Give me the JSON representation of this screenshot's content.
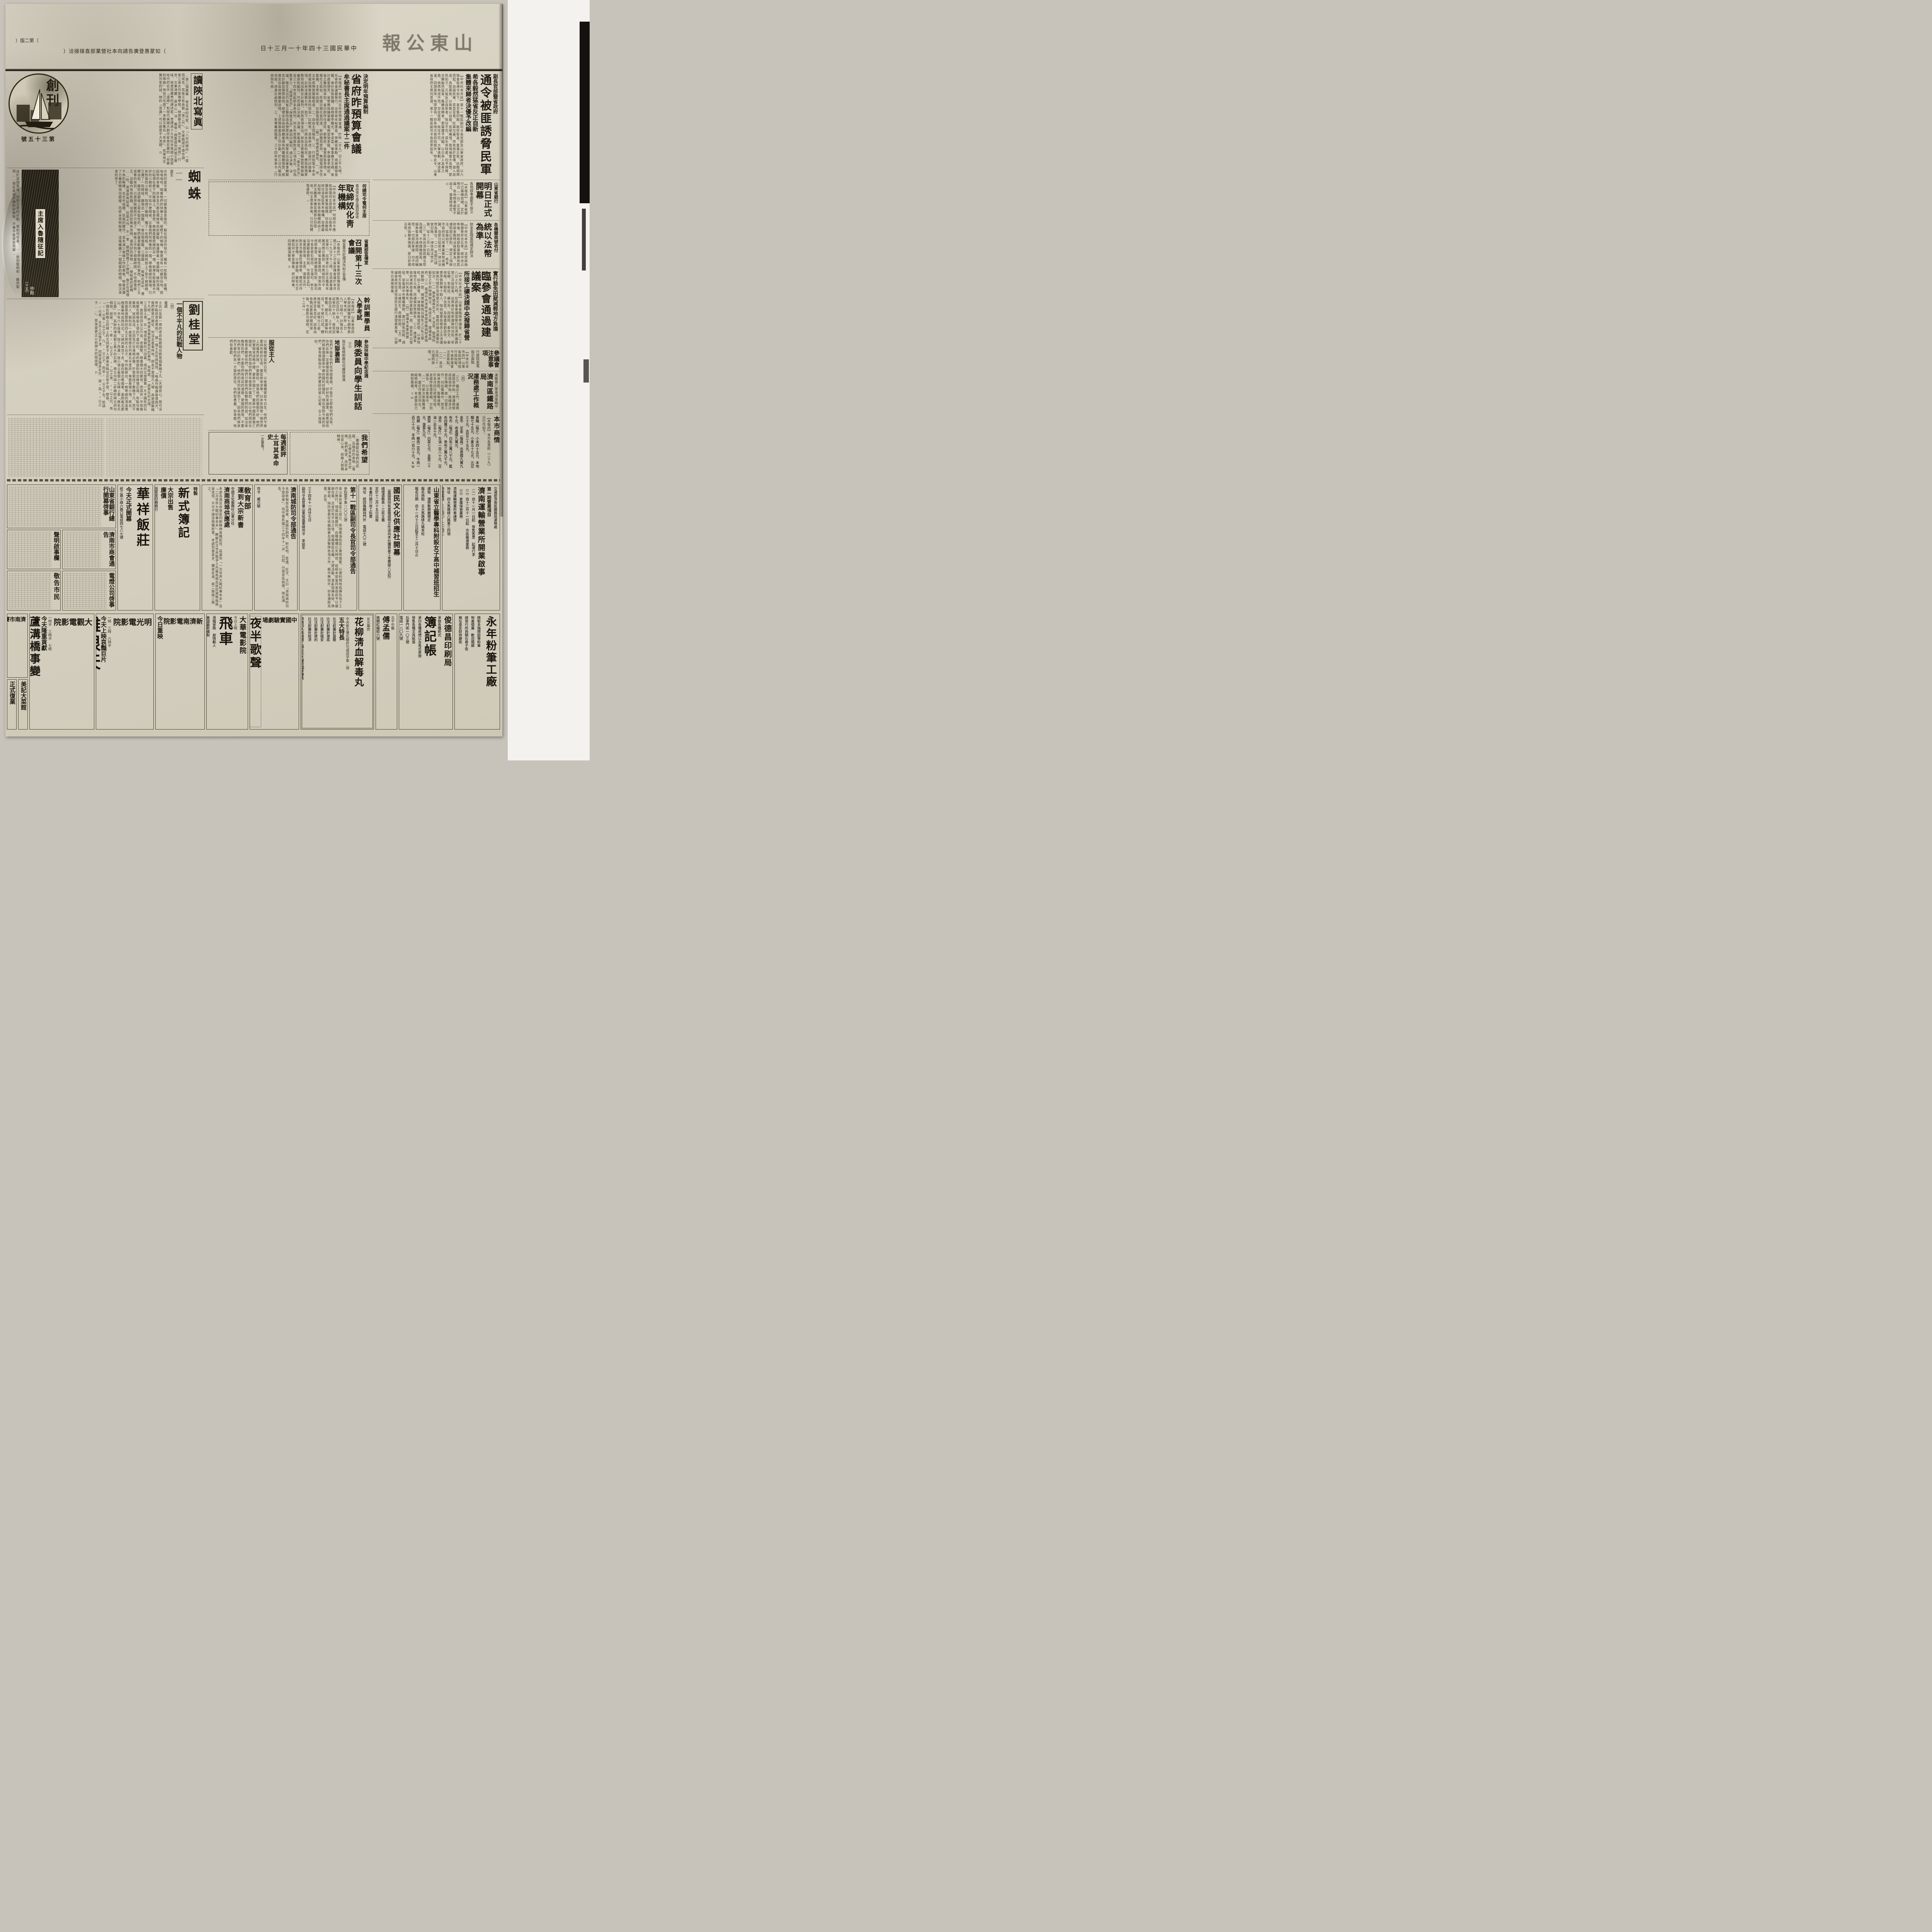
{
  "page": {
    "edition": "（第二版）",
    "title": "山東公報",
    "date": "中華民國三十四年十一月三十日",
    "ad_note": "（如蒙惠登廣告請向本社營業部直接接洽）"
  },
  "articles": {
    "tongling": {
      "kicker": "副長官部曁省政府",
      "title": "通令被匪誘脅民軍",
      "sub1": "希各毅然猛省反正自新",
      "sub2": "集體來歸者決優予改編",
      "body": "【中央社本市訊】第十一戰區副司令長官部及山東省政府、以六號會銜通令如下、查吾魯同胞、賦性耿直、素秉正氣、抗戰揭桿而起、自組民軍、其意至善、壯舉可嘉、然有惑於宣傳、誤入歧途、為匪裹脅、以致無以自拔、良堪痛惜、我領袖寬大為懷、愛民如子、凡能反正自新者、既往不究、其生命財產、均予保障、甘願毅然猛省、集體來歸者、更當優予改編、以示與人為善之路、倘再執迷不悟、甘從匪邪、既往不究、大軍進剿、迷途匪遙、回頭是岸、有厚望焉、仰各地方政府知照外、特此令、山東省政府主席何思源、第十一戰區副司令長官李延年、○"
    },
    "yusuan": {
      "kicker": "決定明年預算編制",
      "title": "省府昨預算會議",
      "sub": "牟秘書長主席通過議案十二件",
      "body": "【本報訊】省府卅五年度預算會議、於昨（廿九）日上午九時、在省府會議廳舉行、出席者牟秘書長、齊廳長季勳、總務廳張金鑑、會計長張敦鏞、政務廳李繼光、李卓雲、軍事廳王文輝、會計處姜德芳、省警察局鍾肇慶、電務室欒季龍、參議會李曉初、省立醫院張卓如、省印刷所任清民、劉惠民、省黨部張貴禮、本報社王砥如、民國日報社張同遠、幹訓團周雯然、無錢電總台任聖農、主席牟尚齋、記錄葛經堂、（略）由張處長報告、一、卅五年度預算籌編經過、二、自由主席報告、三、行政院電令本年度歲出預算並將各科目造一比較表、逐條申述、旋進行討論事項、計表決議案七件、如下、一、行政支出各科目、應就原預算數目追加數合計編列、其他各項支出、就各主管機關查照預算編審原則編列、可否請公決案、決議、照案通過、二、「衛生支出」自三十四年度起即未奉核列、卅五年度預算對該三項支出、均為數甚少、「經建支出」「保警支出」應如何編列、請公決案、決議、衛生支出仍由省立醫院造具預算送核、保警支出由軍事廳擬定計劃及預算送核、經建支出由政務廳彙總各所屬機關預算、經建支出由政務廳彙送核、上述預算書及工作計劃、於三日內編造完竣、送會計處核列、三、各專署經臨費、三十四年係奉令（行政院午儉…"
    },
    "quti": {
      "kicker": "何總司令電何主席",
      "sub": "着由靑年團支團部接收",
      "title": "取締奴化靑年機構",
      "body": "【中央社本市訊】何總司令應欽頃電何主席思源、以偽靑年團及新民會等組織、均為敵偽奴化淪陷區靑年機構、自應嚴加取締、所有各該機關統由三民主義靑年團支團部分別接收、何主席奉命後、已分別轉電遵照、○"
    },
    "xuanchuan": {
      "kicker": "省黨部宣傳室",
      "title": "召開第十三次會議",
      "sub": "關金黑市貶價決作糾正宣傳",
      "body": "【本報訊】山東省黨部宣傳室召開之第十三次省宣傳會議於本月二十九日下午二時、在該處會議室舉行、出席者計三民主義靑年團濟南分團部、濟南城防司令部、山東省會警察局、濟南市政府郭春堂、政務廳張同欽、副司令長官部石雨田、艾蓮村、新生活運動會劉丹宸、市黨部孟科、省黨部宋榮、主席、議案五件、對本市關金貶價現象、應如何作糾正宣傳、以維金融、慶祝元旦應如何大舉宣傳案、研討時事、四時圓滿散會、P"
    },
    "bank": {
      "kicker": "山東省銀行",
      "title": "明日正式開幕",
      "sub": "各地辦事處暫不設立",
      "body": "【本報訊】山東省銀行已籌備就緒、定於明日（一日）正式開幕、各地辦事處暫不設立、需要時再定、D"
    },
    "fabi": {
      "kicker": "各機關商號收付",
      "title": "統以法幣為準",
      "sub": "財金金融當局規定辦法",
      "body": "【中央社本市訊】法幣與偽聯銀券折合比率、經中央公佈後、財政部駐冀魯察熱區財政金融特派員張果為、已遵照部訂原則、規定三項辦法、茲錄如下、（一）各省市政府及公用事業曁稅收機關、自即日起收付一律以法幣為單位、（二）各銀行錢號記賬、一律改用法幣計算、從十二月一日起、（三）各商店須按原標法幣為價碼、不得藉機提高、聯銀券暫准流通期間、視同輔幣、一切契約單據、均不得再用偽聯券價碼、即日折標法幣、E"
    },
    "linsan": {
      "kicker": "實行豁免田賦減輕地方負擔",
      "title": "臨參會通過建議案",
      "sub": "所接工礦決請中央撥歸省營",
      "body": "【中央社本市訊】山東省臨時參議會、於二十八日上午九時、在該會會議室舉行在濟參議員第三次談話會、出席者計有參議員何冰如、宋從頤、李郁廷、蘇文奇、田誼民、秦亦文、秦啓梅、王勉民、于治堂、及祕書長劉幼亭、祕書李佩賢等十餘人、除由祕書長報告上次決議案執行情形及收發文件外、當經討論決議案件如次、（一）推參議員亦文、于治堂、整理所擬定之平抑物價辦法、與成方案、建議省政府、（二）電請中央准將本省接收敵偽財產物資劃撥一部、補償被敵偽佔損失之公私立學校、如工礦等、一律撥歸省營或民營、以資恢復地方元氣、而補償民眾損失、（三）建議省政府速將接收敵偽財產劃撥一部、使其早日復學、以利失學靑年、（四）建議本省軍政當局、並電請中央購糧預算、實行豁免田賦、減輕地方負擔、以維民生、而蘇民困、（五）建議省政府從速恢復民生銀行清理委員會、以便早日清理復業、"
    },
    "zhuyi": {
      "title": "參議會注意事項",
      "sub": "行政院來電指示兩點",
      "body": "【中央社本市訊】山東省政府頃接行政院電、今後參議會注意兩點、（一）…（二）准司法院三十…已遵照辦理、W"
    },
    "tielu": {
      "kicker": "運輸第八軍來濟車輛中",
      "title": "濟南區鐵路局",
      "title2": "運務處工作概況",
      "part": "（四）",
      "body": "（乙）最近工作、運務處接收伊始、適運務號誌接收伊始、路線迭次發生障礙、故一切要工作、均在籌備中、膠濟與津南間、籌備通車、於本月四日修理完竣、並循序整理車輛、分別緩急、以次推進中、（一）列車次第籌備通車、最近作概況列左、組時刻等、本處事前已綿密籌備、TW"
    },
    "ganxun": {
      "title": "幹訓團學員",
      "title2": "入學考試",
      "body": "【本報訊】山東省政府幹部訓練團第七期學員入學考試、於昨（廿九）日舉行、計報名人數四百四十餘人、缺筆試者四十餘人、故受試者四百餘人、上午考試黨義、國文、常識等科目、下午舉行口試、體格檢驗、試場分三處、秩序至為良好、試卷由各甄試委員評閱完竣後、今晨即可發榜、定十二月一…"
    },
    "shangqing": {
      "title": "本市商情",
      "intro": "【本報訊】本市各貨昨（二十九）日行市如下、",
      "items": [
        "食糧（每斤）小米四十五元、本地麵七十五元、小麥五十七元、元豆三十元、吉豆三十五元、",
        "金市　足金（每兩）出貨價九萬九千元、收進價九萬元、",
        "布市（每疋）白布三萬八千元、藍布四萬三千元、靑布三萬九千元、",
        "油市（每斤）生油一百八十元、豆油一百五十元、",
        "蔬菜（每斤）白菜七元、韭菜二十元、菠菜九元、",
        "肉類（每斤）豬肉二百元、牛肉一百三十元、羊肉一百六十元、KW"
      ]
    }
  },
  "features": {
    "shanbei": {
      "title": "讀陝北寫眞",
      "body": "…第二個蕭軍·是吉林的作家、以「八月的鄕村」一書而成名、其後又有長篇「第二代」、文章粗疏不堪卒讀、第三是女作家陳學昭、她是散文家、有文集「倦旅」行世、文筆淸麗·是冰心一派·最後一個要提到的是王實味、他是很優秀的譯述家、曾譯過十九世紀末英國小說家哈代的名作「還鄕」和現代美國大劇作家奧尼爾的「奇異的揷曲」他自己也寫了一本散文集名「休息」、如果用左翼作家的話、她的「意識」可以說是不大淸礎、D"
    },
    "emblem": {
      "chars": "創刊",
      "issue": "第三十五號"
    },
    "zhizhu": {
      "title": "蜘蛛",
      "dash": "——",
      "author": "雲生",
      "body": "炎熱的夏天裏、一切都像窒息般的、躱在陰涼的地方、獨有一些動物、蒼蠅、嗡嗡嗡地、唱着牠們的快樂之歌、屋檐下的蜘蛛、像是沒有一切顧忌似地、挺起牠的身軀、許多支爪都在積極地向前蠕動、後邊帶着一道銀線、線的頂端、已粘滯在檐下的椽端上、看意思、蛛蜘是要把線的另一端、粘滯在距屋檐半尺許的小樹枝上、不知什麼時候、正像我們所想像的一樣、帶着銀線的椽端、已和對面的小樹枝、取得了聯絡、擱了一些時候、與小樹枝掛上了若干條銀線、又擱了一些時候、顯現出一個圓、一會兒兩個圓、三個圓……蜘蛛在其中、運轉自如、顯然這銀線上是有黏性的、牠們最喜歡蹲食帶黏性的東西、牠們三五成羣的來到、已是想脫離而不可能了、蜘蛛工作到了相當時間、不但感覺疲乏、且腹內有些飢餓、沒想到趁着休息時、還有好的食物——被粘着的蒼蠅——吃、黑雲密佈起來、狂風大作·不一會·銀線脫離了小樹枝、像正在搖個不休的鞦韆、在空中搖擺、狂風的驟作、並未減少蜘蛛工作的勇氣、牠像用盡了力量把精持住銀線、而終未使牠脫落、這樣繼續了一個相當的時間、兩次漸漸的停了、"
    },
    "suixing": {
      "title": "主席入魯隨征記",
      "part": "（十五）",
      "author": "仲勛",
      "body": "由於這個電報、可知主席的計劃、是如何完善、……敖到黎明呢·雖然黎明……現在竟被扞擁粉碎無餘、不筆不能建設很變…"
    },
    "liuguitang": {
      "title": "劉桂堂",
      "kicker": "一個不平凡的抗戰人物",
      "author": "雷諾",
      "part": "（四）",
      "body": "士兵以及那一帶的老百姓都相信劉是個鱉精下凡（天理良心、我可沒有半點惡意來罵他）、據一個士兵告訴我說、「每逢作戰遇着落雨天、我們都是打勝仗、你沒去看看林地、師長不是個凡人哪·眞是個鱉精下凡呢、」林地是指着劉家祖先的墓地、有兩處、一處是在村北端、三五個土墳、在一塊很偏僻的方田裏、墳的北面露着一片半圓形的石層、直徑有四五公尺長、很圓整、極像個大的鱉背、而其另一半就像是壓在那幾座土墳的下邊似的、墳的南面則突出幾塊石頭、有點兒像鱉頭、就因為這、又因為打仗逢雨必勝、於是劉成了鱉精下凡、而不是凡人、劉的另一處祖塋是在村東北半里許、後面是個小嶺、將台、西面是個整齊的四五丈高的土台子、呼作點將台、一條彎曲的淸溪環繞着墓地由西向北、又繞向東流下去、墓向是北略偏東、遙對着北蒙山、一共有六七座墳、除了西邊一座小墳立着個小石碑上書「無名氏之墓」外、其餘的墳前都立着大的石碑、碑文均與二郎廟的碑文詞句相倣、就是、「××者××公之子、××公之弟、××公之兄、有一個比較晚立的碑上的文詞更令人讚後有點兒忍俊不禁、那是、「××公者×公之子、乃××公之子、而非××公之子也、前誤××公者、太夫人記憶不淸、因桂堂隨其在外、誤×為××公之子……」、原來是更正以前碑文的錯誤哪、D"
    },
    "xunhua": {
      "kicker": "參加扶輪中學紀念週",
      "title": "陳委員向學生訓話",
      "part": "（三）",
      "sub": "指示兩條明路句句痛快淋漓",
      "sec1": "地獄裏面",
      "body1": "我們不能看你們在地獄裏面、不能不立即救你們出來、你們此後一定要服從張校長、好好的來讀書、我希望你們將來個個都是中華民國的好國民、現在我對今後的你們、留有兩點指示、你們要好好留心記着、古人說得好、",
      "sec2": "服從主人",
      "body2": "以前種種譬如昨日死、以後種種譬如今日生、你們今後要與有新的生命、要從新來求學、日本民族是一個世界上的優秀民族、什麼都好、就是他們的軍閥不好、他們的軍閥來侵略中國、要將中國亡了、要將中國民都做亡國奴、他們恐怕你們靑年是愛中國的、所以他們用奴化教育來教育你們、他們只要你們肯聽他們的話、如法來教育你們、不要你們有高尚的道德、愛國的思想、不要你們有好的學們、他們的目的就達到了、因為他們將來們不要你們負一方面的責任、你們愈愚蠢、愈卑鄙、他們愈喜歡、"
    },
    "wishes": {
      "title": "我們希望",
      "body": "…繼續獻出他們的武器、及積存的食物（毒品）、以便多來幾次焚燒、我們希望、商民拿出良心來、給敵人那種精神、"
    },
    "yingping": {
      "title": "每週影評",
      "film": "土耳其革命史",
      "note": "一定要看！"
    }
  },
  "notices": {
    "jinggao": {
      "title": "敬告市民"
    },
    "diandeng": {
      "title": "電燈公司啓事"
    },
    "shengbank": {
      "title": "山東省銀行總行開幕啓事"
    },
    "shanghui": {
      "title": "濟南市商會通告"
    },
    "shengming": {
      "title": "聲明啟事欄"
    },
    "classifieds": {
      "lines": [
        "正式復業",
        "三奇",
        "保三製藥廠總發售",
        "精製滅痙疥癬",
        "統治各科",
        "雅潔養病室",
        "隨意入院",
        "女醫師接生",
        "隨請隨到"
      ]
    }
  },
  "ads": {
    "yunshu": {
      "header": "交通部濟南區鐵路局運務處",
      "tag": "第一期營業項目",
      "title": "濟南運輸營業所開業啟事",
      "lines": [
        "（一）自十一月一日起　發售客票　起運行李",
        "（二）自十二月十一日起　市區搬運業務",
        "（三）倉庫保管業務",
        "濟南運輸營業所奉謹啓"
      ],
      "addr": "地址　四大馬路緯六路第三四號",
      "tel": "商用電話　二七四〇　二七四二"
    },
    "yixue": {
      "title": "山東省立醫學專科附設女子高中補習班招生",
      "lines": [
        "課程　遵照敎務廳規定",
        "報名地點　五大馬路緯九路本校",
        "報名日期　自十一月十三日起至十二月十日止"
      ]
    },
    "guomin": {
      "title": "國民文化供應社開幕",
      "lines": [
        "（黨國員持有黨團證明文件逕向本社購買者工本費按八五扣）",
        "總理遺敎表・三民主義",
        "定於十二月十五日出版",
        "本書行銷只收工料費",
        "地址　經四路麟祥門外　電話七〇二號"
      ]
    },
    "zhan11": {
      "title": "第十一戰區副司令長官司令部通告",
      "number": "參鈞璽字第一〇〇三號",
      "body": "查山東各軍區之設立、係適應淪陷區之實際需要、以便利現地指揮及地下工作之推行、現值抗戰勝利、此種機構已失時效、前經本部會同省政府予以撤銷在案、近查仍有不法之徒、假藉軍區名義、大肆活動、淆亂指揮系統、殊屬非是、除所發委任收編偽軍及游擊隊各項文件、概作無效外、仰各遵照為要、此告、",
      "date": "三十四年十一月廿七日",
      "signer": "副司令長官兼山東挺進軍總司令　李延年"
    },
    "chengfang": {
      "title": "濟南城防司令部通告",
      "body": "本部新製官佐證章、係圓形銅質、粉紅地、藍邊、紅字、文曰「濟南城防司令部證章」、自中華民國三十四年十一月　日起、分發官佐佩帶、特此通告、",
      "signer": "司令　臧元駿"
    },
    "jiaoyu": {
      "kicker": "敎育部",
      "title": "運到大宗新書",
      "agency": "中國文化服務社山東分社",
      "office": "濟南商埠供應處",
      "body": "本處為滿足收復區同胞精神食糧起見、茲運到「一次世界大戰紀事本末」及「二次世界大戰紀事本末」、瞭解此次世界戰爭之內幕眞相及欲認識戰後建設途徑、不可不讀這兩種新書、本處到書甚多、購者從速、經二路緯三路之。"
    },
    "buji": {
      "tag": "特製",
      "title": "新式簿記",
      "tag2": "大宗出售",
      "price": "廉價",
      "seller": "恒翠堂印務商行",
      "addr": "經三路緯一路二三八號",
      "tel": "電話一八五四"
    },
    "huaxiang": {
      "title": "華祥飯莊",
      "sub": "今天正式開幕",
      "addr": "經三路小緯六路口電話四七八七號"
    },
    "fenbi": {
      "title": "永年粉筆工廠",
      "lines": [
        "精製多福牌超等粉筆",
        "物美價廉　歡迎賜顧",
        "總發行所西關石巷子街",
        "廠址泰安財政廳街"
      ]
    },
    "junde": {
      "title": "俊德昌印刷局",
      "big": "簿記帳",
      "lines": [
        "承做各種新式",
        "承印各種商標以及各式表冊",
        "發售各種文具紙張",
        "后宰門街一〇三號",
        "電話一八〇九號"
      ]
    },
    "fumengru": {
      "kicker": "北平中醫",
      "title": "傅孟儒",
      "addr": "南關紅牆街六號"
    },
    "huajiu": {
      "shop": "友光藥房",
      "title": "花柳淸血解毒丸",
      "cert": "中央衛生署化驗許可證成字第…號",
      "feature_head": "五大特長",
      "features": [
        "比注射藥針靈驗",
        "比注射藥針澈底",
        "比注射藥針穩安",
        "比注射藥針便利",
        "比注射藥針經濟"
      ],
      "body": "專治梅毒、及多年餘毒未淨、毒串週身、筋骨酸痛、疔毒惡瘡、毛髮脫落、皮膚常現紅斑紅點、花柳性疥癩癬瘡、婦女被染花柳、遺傳性小兒胎毒、發現五淋白濁、尿道軟硬下疳、便毒魚口、橫痃瘰癧、淸之症、服（花柳淸血解毒丸）專能搜滅血毒內菌、無論男女老幼、均可澈底淸根、決無再犯花柳之處、功效勝過打藥針十倍、在濟南行銷年以上成績、曾經三次化驗、",
      "dealer": "濟南四大馬路緯二路友光大藥房獨家專售"
    },
    "juchang": {
      "title": "中國實驗劇場",
      "show": "夜半歌聲",
      "lines": [
        "今日最後一天",
        "明日夜場上演",
        "四幕二景大喜劇"
      ],
      "show2": "陽關三疊"
    },
    "dahua": {
      "title": "大華電影院",
      "note": "今日上映",
      "film": "飛車",
      "lines": [
        "滑稽冒險　劇情動人",
        "美國最新攝製",
        "五彩卡通",
        "時間　二時　四時　七時",
        "地址緯三路舊山東映畫院"
      ]
    },
    "xinjinan": {
      "title": "新濟南電影院",
      "note1": "今日重映",
      "note2": "英茵遺作",
      "film": "返魂香",
      "lines": [
        "劇情動人　百觀不厭",
        "日場二時　夜場七時",
        "地址經二路緯三路南"
      ]
    },
    "mingguang": {
      "title": "明光電影院",
      "times": "一時　三時　六時半",
      "note": "今天上映哀豔巨片",
      "film": "離恨天",
      "lines": [
        "主演　錢士英　玲玲",
        "加演七七事變戰爭巨片",
        "欲免擁擠　請早蒞臨"
      ]
    },
    "daguan": {
      "title": "大觀電影院",
      "times": "一時半　三時半　七時",
      "note": "今天隆重貢獻",
      "film1": "蘆溝橋事變",
      "film2": "抗戰歌曲",
      "lines": [
        "加映　美國五彩卡通",
        "新拷貝　盤絲洞"
      ]
    },
    "saima": {
      "title": "濟南市賽馬會",
      "lines": [
        "連續賽馬三日",
        "十一月卅日十二月一二日",
        "（雨天順延）",
        "地址　南郊跑馬場",
        "票價目如左　張法幣二百元　張法幣二十元　法幣十元（次小播彩用）"
      ]
    },
    "meiji": {
      "title": "美記大菜館",
      "lines": [
        "名廚製做",
        "富麗堂皇",
        "地點適中便利",
        "靑年會內"
      ]
    }
  }
}
